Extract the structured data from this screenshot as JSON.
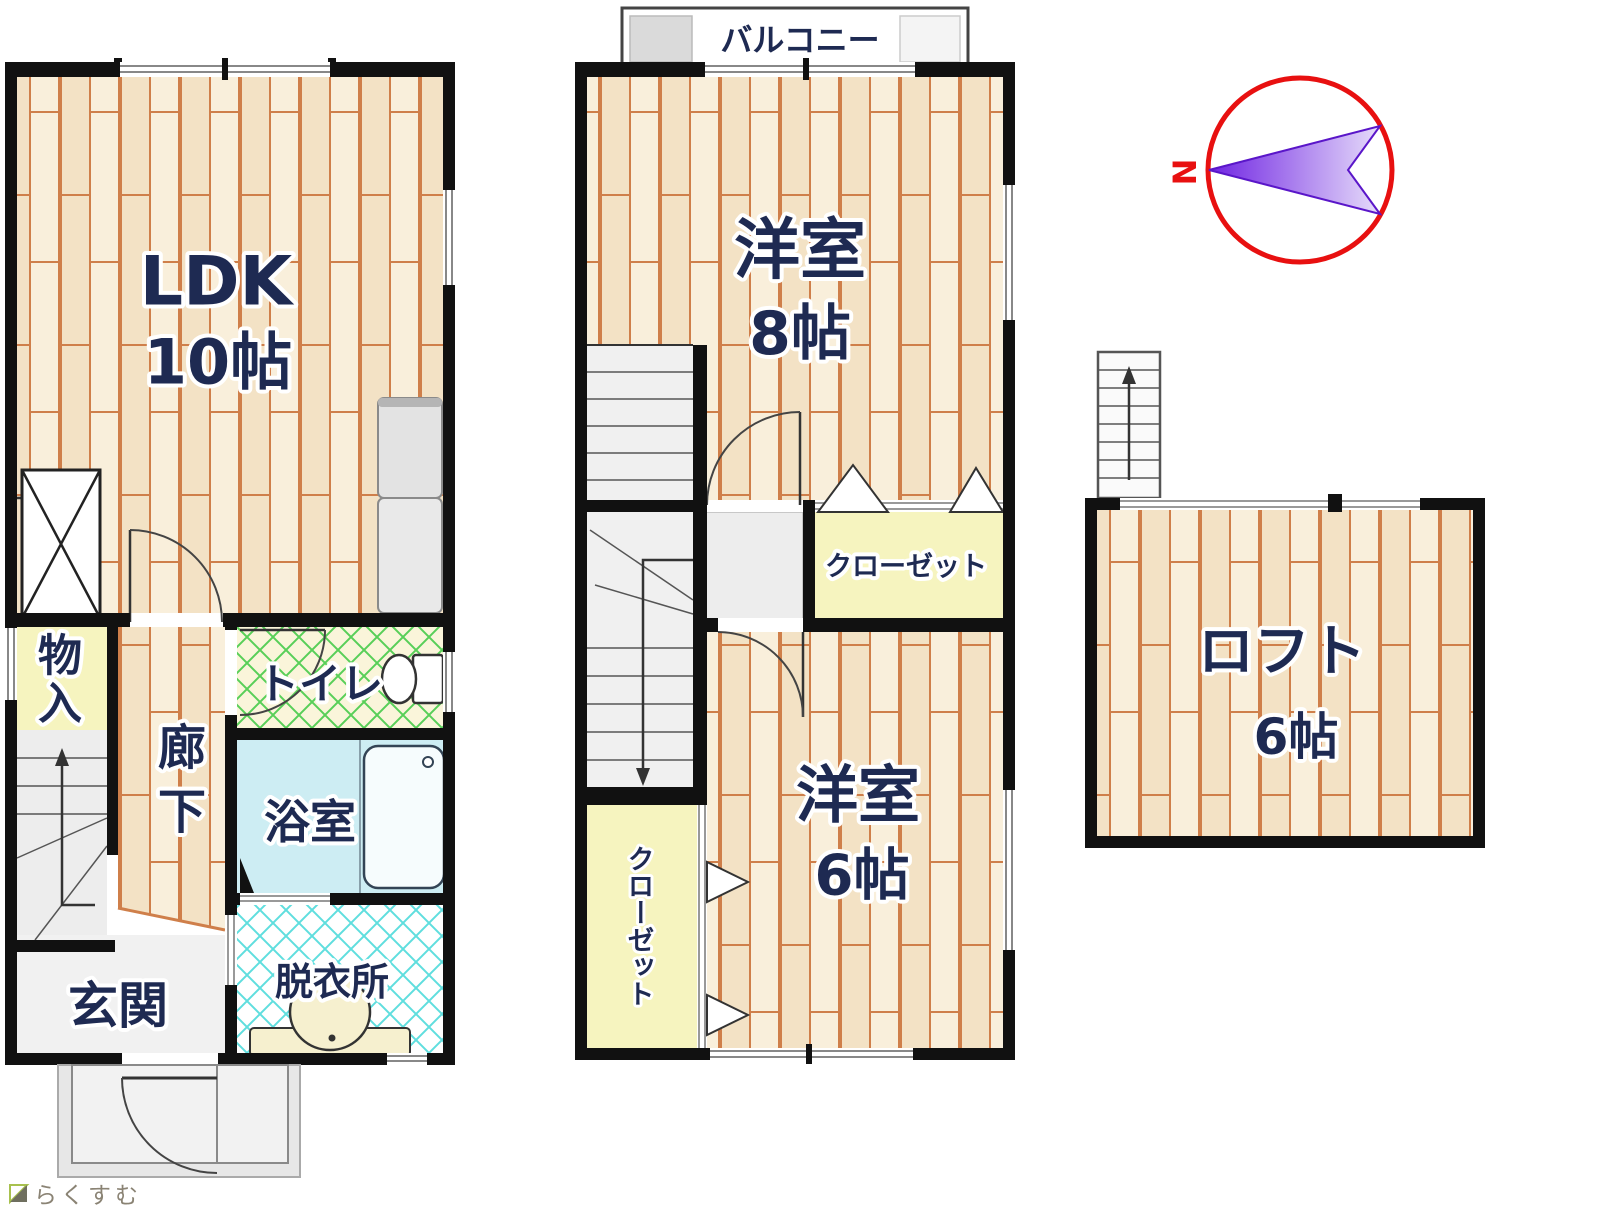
{
  "floorplan": {
    "floor1": {
      "ldk": {
        "label": "LDK",
        "size": "10帖"
      },
      "storage": {
        "chars": [
          "物",
          "入"
        ]
      },
      "corridor": {
        "chars": [
          "廊",
          "下"
        ]
      },
      "toilet": {
        "label": "トイレ"
      },
      "bathroom": {
        "label": "浴室"
      },
      "dressing_room": {
        "label": "脱衣所"
      },
      "entrance": {
        "label": "玄関"
      }
    },
    "floor2": {
      "balcony": {
        "label": "バルコニー"
      },
      "room8": {
        "label": "洋室",
        "size": "8帖"
      },
      "closet8": {
        "label": "クローゼット"
      },
      "room6": {
        "label": "洋室",
        "size": "6帖"
      },
      "closet6": {
        "label": "クローゼット"
      }
    },
    "loft": {
      "room": {
        "label": "ロフト",
        "size": "6帖"
      }
    },
    "compass": {
      "north_label": "N"
    },
    "logo": {
      "text": "らくすむ"
    },
    "colors": {
      "wall": "#111111",
      "wood_base": "#f6e9d0",
      "wood_line": "#cf7f4a",
      "toilet_lattice": "#58cf58",
      "dressing_lattice": "#5fdede",
      "bath_fill": "#cdedf3",
      "closet_fill": "#f6f4bf",
      "gray_floor": "#ededed",
      "compass_ring": "#e81010",
      "compass_needle": "#6f23e2",
      "label_color": "#1e2a52"
    }
  }
}
